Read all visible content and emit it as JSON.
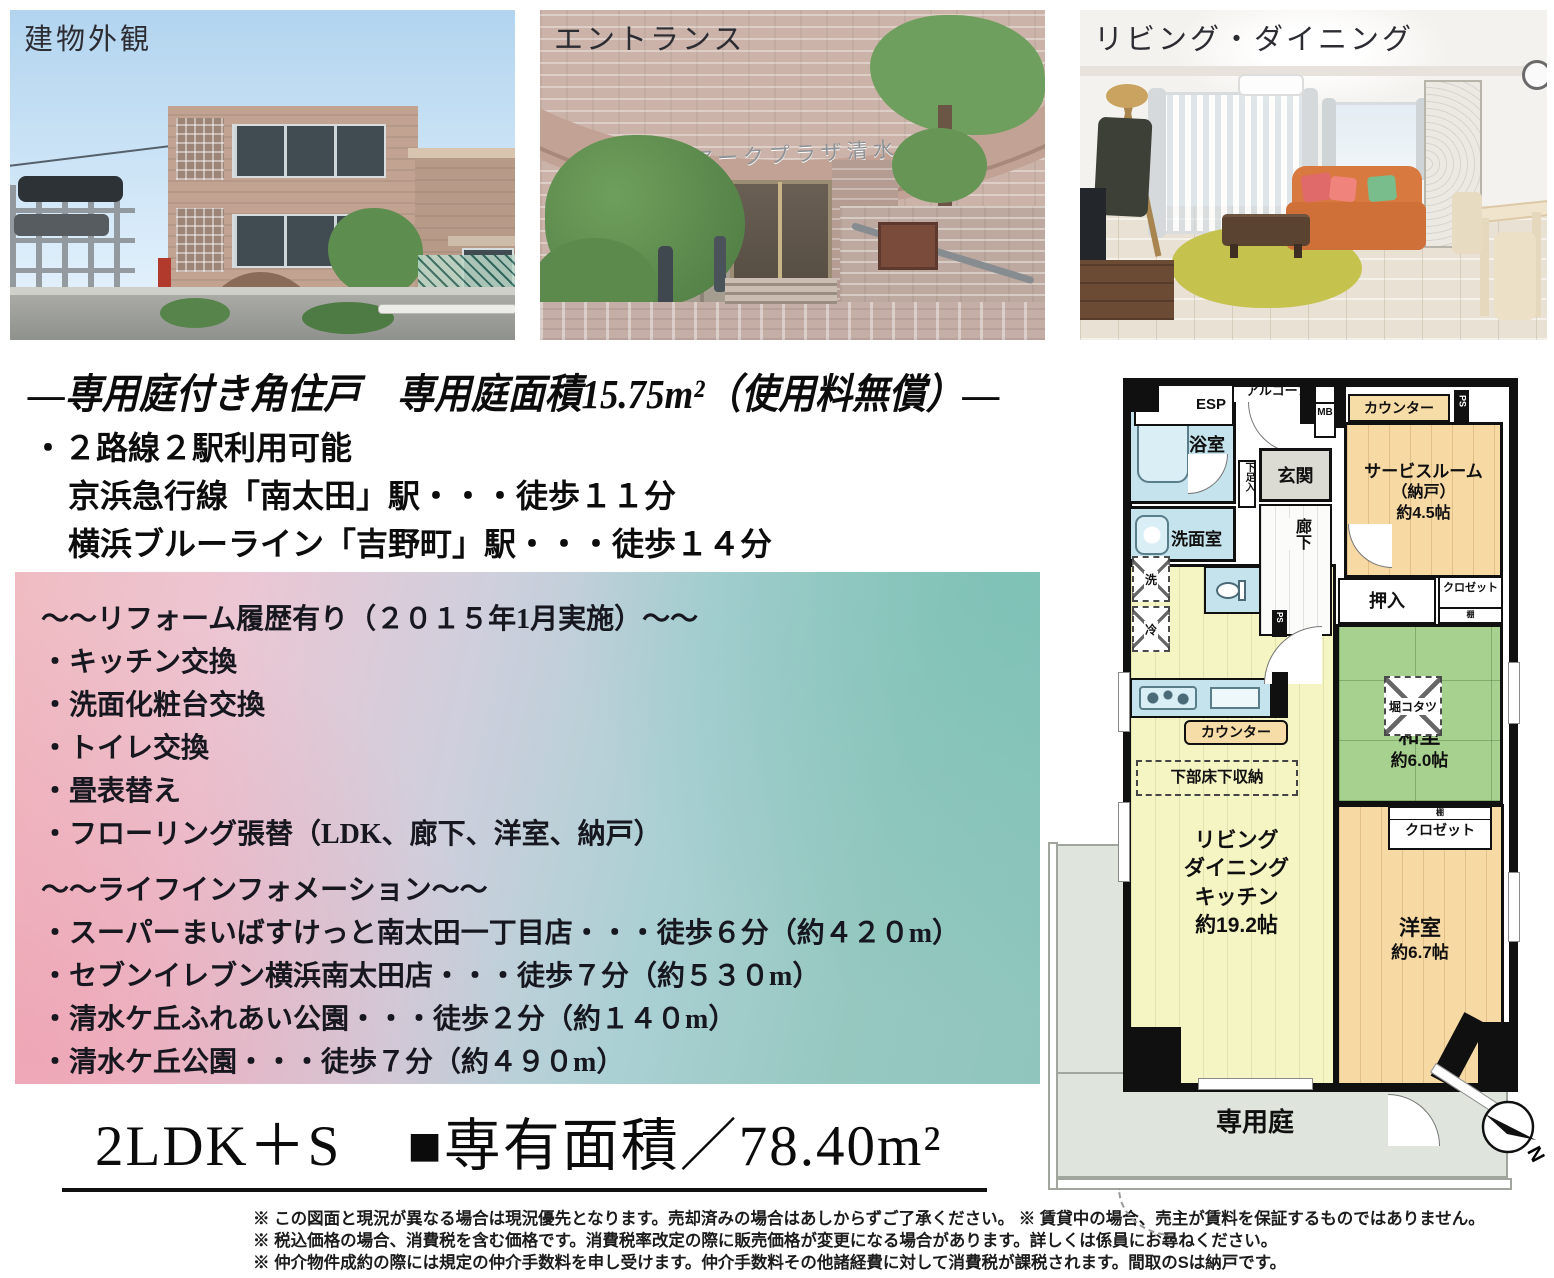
{
  "photos": {
    "p1_label": "建物外観",
    "p2_label": "エントランス",
    "p3_label": "リビング・ダイニング",
    "p2_sign": "アークプラザ清水ヶ丘"
  },
  "headline": "―専用庭付き角住戸　専用庭面積15.75m²（使用料無償）―",
  "access": {
    "line1": "・２路線２駅利用可能",
    "line2": "京浜急行線「南太田」駅・・・徒歩１１分",
    "line3": "横浜ブルーライン「吉野町」駅・・・徒歩１４分"
  },
  "info_box": {
    "reform_title": "～～リフォーム履歴有り（２０１５年1月実施）～～",
    "reform_items": [
      "・キッチン交換",
      "・洗面化粧台交換",
      "・トイレ交換",
      "・畳表替え",
      "・フローリング張替（LDK、廊下、洋室、納戸）"
    ],
    "life_title": "～～ライフインフォメーション～～",
    "life_items": [
      "・スーパーまいばすけっと南太田一丁目店・・・徒歩６分（約４２０m）",
      "・セブンイレブン横浜南太田店・・・徒歩７分（約５３０m）",
      "・清水ケ丘ふれあい公園・・・徒歩２分（約１４０m）",
      "・清水ケ丘公園・・・徒歩７分（約４９０m）"
    ]
  },
  "summary": {
    "layout": "2LDK＋S",
    "area": "■専有面積／78.40m²"
  },
  "disclaimers": [
    "※ この図面と現況が異なる場合は現況優先となります。売却済みの場合はあしからずご了承ください。 ※ 賃貸中の場合、売主が賃料を保証するものではありません。",
    "※ 税込価格の場合、消費税を含む価格です。消費税率改定の際に販売価格が変更になる場合があります。詳しくは係員にお尋ねください。",
    "※ 仲介物件成約の際には規定の仲介手数料を申し受けます。仲介手数料その他諸経費に対して消費税が課税されます。間取のSは納戸です。"
  ],
  "floorplan": {
    "esp": "ESP",
    "alcove": "アルコーブ",
    "mb": "MB",
    "ps": "PS",
    "counter": "カウンター",
    "service_room_l1": "サービスルーム",
    "service_room_l2": "（納戸）",
    "service_room_l3": "約4.5帖",
    "bath": "浴室",
    "shoe_box": "下足入",
    "entrance": "玄関",
    "washroom": "洗面室",
    "corridor": "廊下",
    "washer": "洗",
    "fridge": "冷",
    "oshiire": "押入",
    "closet": "クロゼット",
    "shelf": "棚",
    "japanese_room_l1": "和室",
    "japanese_room_l2": "約6.0帖",
    "kotatsu": "堀コタツ",
    "underfloor_storage": "下部床下収納",
    "ldk_l1": "リビング",
    "ldk_l2": "ダイニング",
    "ldk_l3": "キッチン",
    "ldk_l4": "約19.2帖",
    "western_room_l1": "洋室",
    "western_room_l2": "約6.7帖",
    "garden": "専用庭",
    "compass_north": "N"
  },
  "colors": {
    "wall": "#101010",
    "tatami_green": "#a7d18e",
    "service_beige": "#f7d9a4",
    "ldk_yellow": "#f5f4c3",
    "wet_blue": "#c5e3ec",
    "garden_gray": "#dfe4dc"
  }
}
